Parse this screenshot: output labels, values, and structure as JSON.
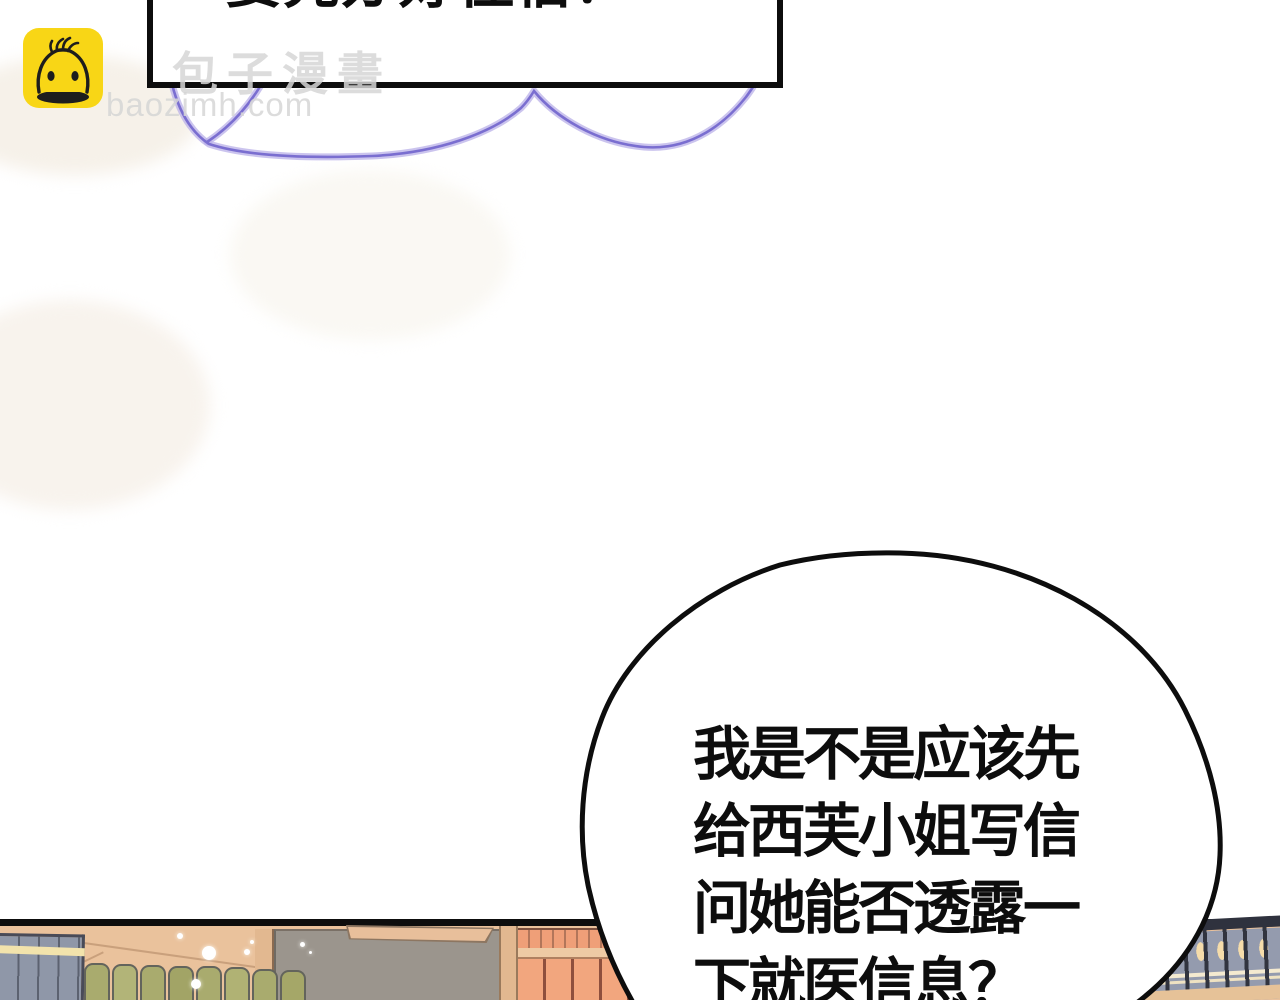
{
  "watermark": {
    "brand_cn": "包子漫畫",
    "brand_url": "baozimh.com"
  },
  "caption_box": {
    "text": "要先办好住宿！"
  },
  "speech_bubble": {
    "lines": [
      "我是不是应该先",
      "给西芙小姐写信",
      "问她能否透露一",
      "下就医信息？"
    ]
  },
  "colors": {
    "ink": "#0d0d0d",
    "logo_yellow": "#f8d616",
    "watermark_gray": "#d6d6d6",
    "cloud_purple": "#7a6ed0",
    "cloud_glow": "#b9b0e8",
    "panel_tan": "#eac29c",
    "blue_book": "#8f97a8",
    "blue_book_line": "#5c6270",
    "blue_book_stripe": "#f2e3ac",
    "green_book": "#a9ab6e",
    "green_book_line": "#63645c",
    "gray_cabinet": "#9b958d",
    "board_tan": "#e8bf9b",
    "board_edge": "#8d7661",
    "post_tan": "#e2b890",
    "salmon_book": "#f2a67e",
    "salmon_line": "#8e4f3d",
    "small_book": "#ef9f78",
    "shelf_board": "#eecaa4",
    "rail_dark": "#2f323e",
    "rail_panel": "#949bae",
    "rail_post": "#31343f",
    "rail_oval": "#f5dcaa",
    "rail_stripe": "#f4ead0",
    "floor_tan": "#e6c298"
  }
}
